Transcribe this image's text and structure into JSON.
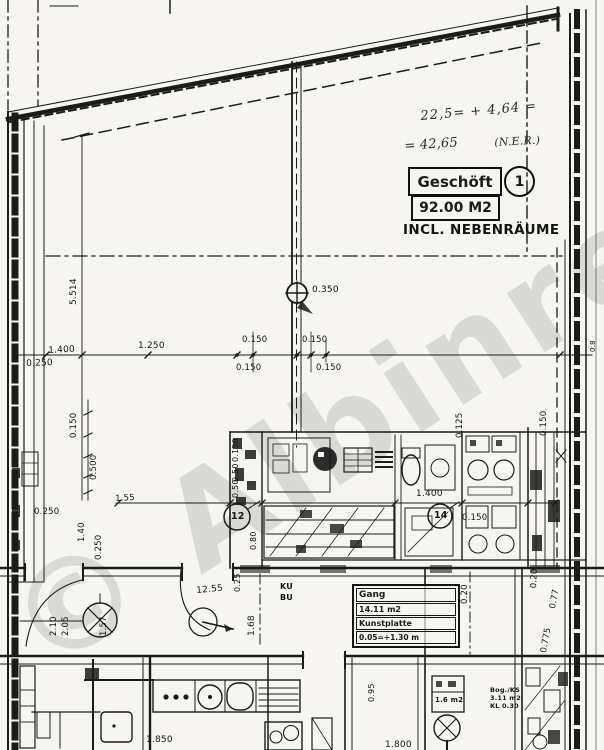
{
  "watermark": {
    "text": "© Albinre"
  },
  "annotations": {
    "handwriting_line1": "22,5= + 4,64 =",
    "handwriting_line2": "= 42,65",
    "handwriting_note": "(N.E.R.)"
  },
  "stamp": {
    "room_name": "Geschöft",
    "room_number": "1",
    "area": "92.00 M2",
    "note": "INCL. NEBENRÄUME"
  },
  "gang_box": {
    "name": "Gang",
    "area": "14.11 m2",
    "floor": "Kunstplatte",
    "level": "0.05=+1.30 m"
  },
  "small_room_box": {
    "area": "1.6 m2"
  },
  "right_room_block": {
    "line1": "Bog./KS",
    "line2": "3.11 m2",
    "line3": "KL 0.30"
  },
  "symbols": {
    "column_offset": "0.350",
    "circle_a": "12",
    "circle_b": "14",
    "label_ku": "KU",
    "label_bu": "BU"
  },
  "dims": {
    "v5514": "5.514",
    "h1400a": "1.400",
    "h0250a": "0.250",
    "h1250": "1.250",
    "t0150a": "0.150",
    "t0150b": "0.150",
    "b0150a": "0.150",
    "b0150b": "0.150",
    "c0350": "0.350",
    "l0150": "0.150",
    "l0500": "0.500",
    "l0250": "0.250",
    "l140": "1.40",
    "l0250b": "0.250",
    "m155": "1.55",
    "c0150": "0.150",
    "c050a": "0.50",
    "c050b": "0.50",
    "c080": "0.80",
    "c025": "0.25",
    "h1400b": "1.400",
    "h0150": "0.150",
    "r0125": "0.125",
    "r0150": "0.150",
    "r020": "0.20",
    "r077": "0.77",
    "r0775": "0.775",
    "r08": "0.8",
    "b210": "2.10",
    "b205": "2.05",
    "b157": "1.57",
    "b1255": "12.55",
    "b168": "1.68",
    "b020": "0.20",
    "b1850": "1.850",
    "b1800": "1.800",
    "b095": "0.95"
  }
}
